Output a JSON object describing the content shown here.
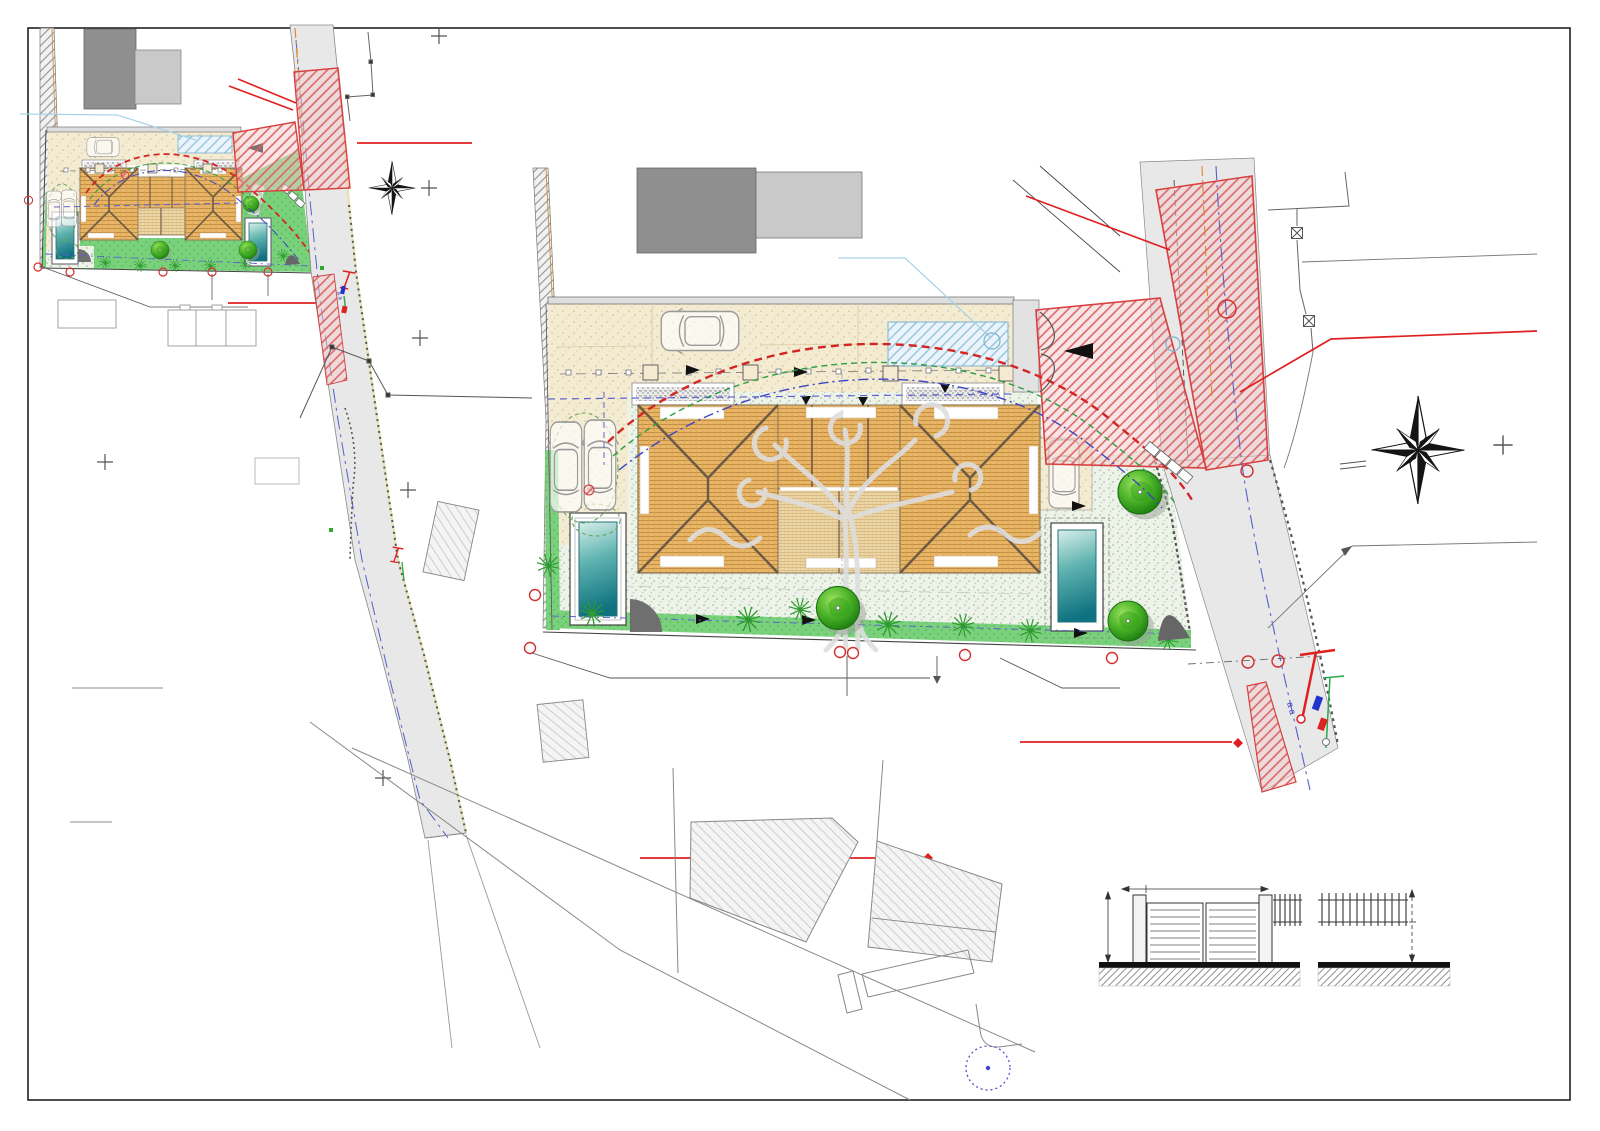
{
  "document": {
    "title": "Architectural site plan drawing",
    "description": "Site / landscape plan: small location inset (top-left), large detailed plan with two hip-roof villas, pools, garden, vehicle swept-path curves, red road-works hatching, compass roses, and gate & fence elevation details (bottom-right)",
    "sheet_background": "#ffffff",
    "frame_color": "#222222"
  },
  "palette": {
    "roof_tile": "#e9b566",
    "roof_tile_line": "#c08a3c",
    "roof_ridge": "#6b5a45",
    "driveway_beige": "#f3ebd2",
    "terrace_stipple": "#eef3ea",
    "lawn_green": "#7ad17c",
    "gravel_gray": "#ececec",
    "pool_teal_dark": "#0f7280",
    "pool_teal_light": "#d8efe9",
    "tree_green": "#2f9e17",
    "road_gray": "#e8e8e8",
    "roadworks_red": "#d84040",
    "swept_path_red": "#d42525",
    "swept_path_green": "#2b9e43",
    "swept_path_blue": "#3b43c4",
    "survey_centerline_blue": "#5560c8",
    "centerline_orange": "#e0862a",
    "leader_cyan": "#a8d4e8",
    "neighbor_dark_gray": "#8f8f8f",
    "neighbor_light_gray": "#c9c9c9",
    "hatch_gray": "#9a9a9a",
    "watermark_gray": "#dcdcdc"
  },
  "annotations": {
    "road_marks": "a a"
  }
}
